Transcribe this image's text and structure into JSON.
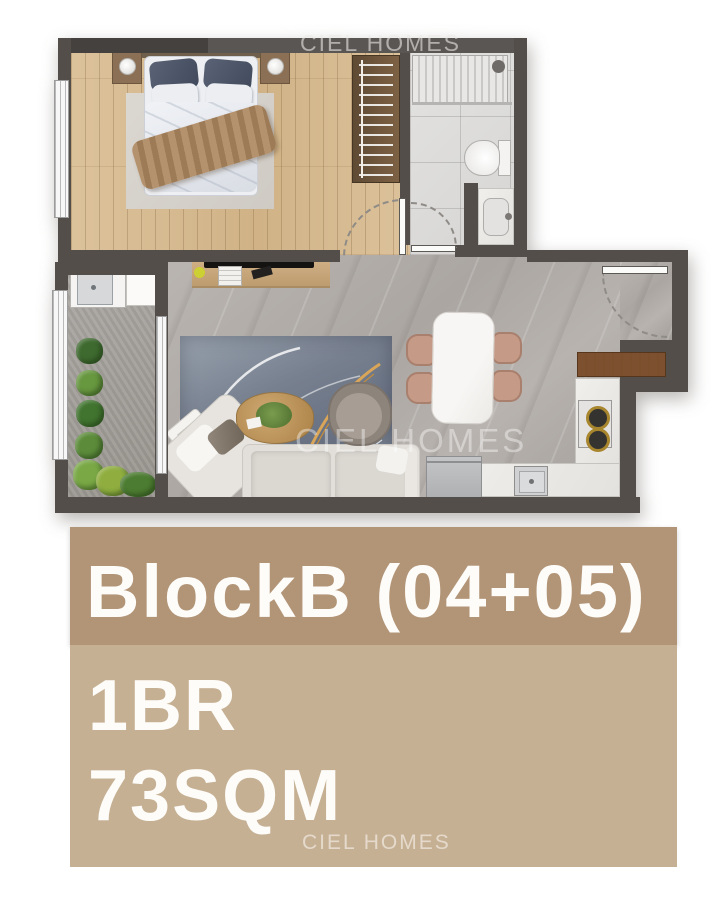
{
  "watermarks": {
    "top": "CIEL HOMES",
    "middle": "CIEL HOMES",
    "bottom": "CIEL HOMES"
  },
  "info_panel": {
    "block_label": "BlockB (04+05)",
    "bedrooms": "1BR",
    "area": "73SQM"
  },
  "colors": {
    "wall": "#534e4a",
    "wood": "#dcc29b",
    "wood-dark": "#d0b286",
    "marble": "#aba6a2",
    "balcony": "#aba7a3",
    "bath": "#e3e2e0",
    "counter": "#f1efec",
    "band-dark": "#b29477",
    "band-light": "#c6b094",
    "label": "#fdfcf8",
    "rug": "#77808f",
    "cabinet": "#7b4e2c",
    "accent-yellow": "#ccd032"
  },
  "plan_items": [
    "double-bed",
    "nightstand",
    "table-lamp",
    "bedroom-rug",
    "wardrobe",
    "radiator",
    "shower-head",
    "glass-screen",
    "toilet",
    "bathroom-sink",
    "interior-door",
    "tv-console",
    "tv",
    "living-rug",
    "coffee-table",
    "plant-pot",
    "lounge-chair",
    "corner-sofa",
    "side-table",
    "dining-table",
    "dining-chair",
    "entrance-door",
    "sliding-door",
    "window",
    "laundry-sink",
    "washing-machine",
    "balcony-plant",
    "wood-cabinet",
    "stove",
    "kitchen-sink",
    "fridge",
    "kitchen-counter"
  ]
}
